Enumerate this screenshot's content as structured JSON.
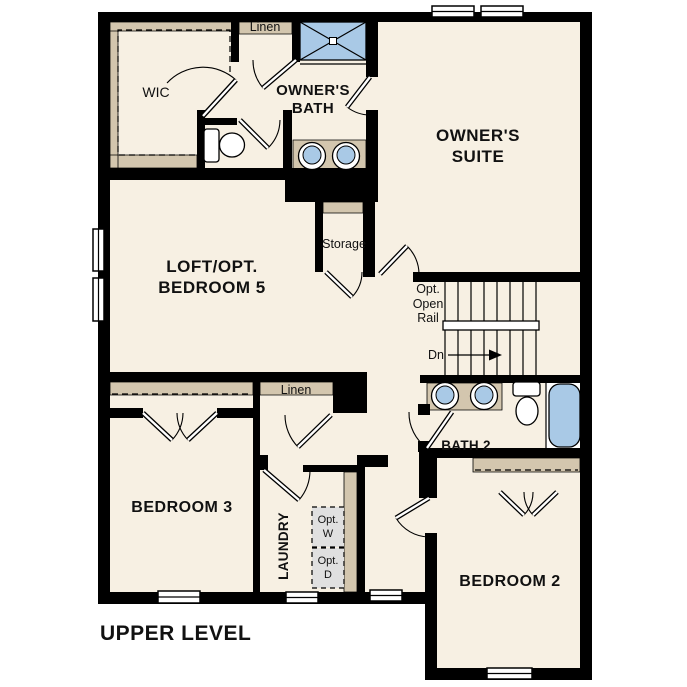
{
  "plan": {
    "title": "UPPER LEVEL",
    "rooms": {
      "wic": {
        "label": "WIC"
      },
      "owners_bath": {
        "line1": "OWNER'S",
        "line2": "BATH"
      },
      "owners_suite": {
        "line1": "OWNER'S",
        "line2": "SUITE"
      },
      "loft": {
        "line1": "LOFT/OPT.",
        "line2": "BEDROOM 5"
      },
      "bedroom3": {
        "label": "BEDROOM 3"
      },
      "bedroom2": {
        "label": "BEDROOM 2"
      },
      "bath2": {
        "label": "BATH 2"
      },
      "laundry": {
        "label": "LAUNDRY"
      }
    },
    "closets": {
      "linen_upper": {
        "label": "Linen"
      },
      "linen_hall": {
        "label": "Linen"
      },
      "storage": {
        "label": "Storage"
      }
    },
    "stairs": {
      "opt_rail_line1": "Opt.",
      "opt_rail_line2": "Open",
      "opt_rail_line3": "Rail",
      "down_label": "Dn"
    },
    "laundry_appliances": {
      "washer": {
        "line1": "Opt.",
        "line2": "W"
      },
      "dryer": {
        "line1": "Opt.",
        "line2": "D"
      }
    },
    "colors": {
      "floor": "#f7f0e3",
      "wall": "#000000",
      "cabinetry": "#d3c6ae",
      "fixtures": "#a9c9e6",
      "appliance_box": "#e0e0e0"
    }
  }
}
